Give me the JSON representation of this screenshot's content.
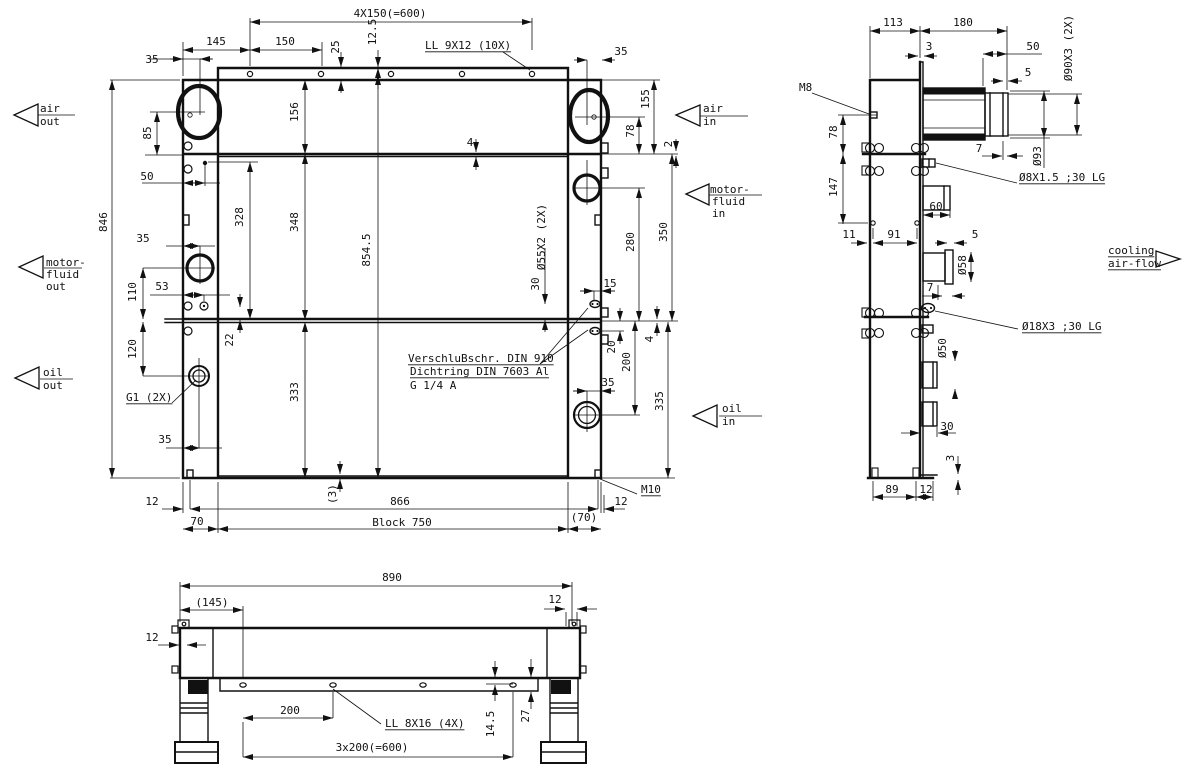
{
  "drawing": {
    "type": "technical engineering drawing",
    "subject": "combined oil / motor-fluid / air cooler with fan, three orthographic views",
    "front_view": {
      "texts": [
        {
          "t": "4X150(=600)",
          "x": 390,
          "y": 17
        },
        {
          "t": "12.5",
          "x": 376,
          "y": 32,
          "r": -90
        },
        {
          "t": "25",
          "x": 339,
          "y": 47,
          "r": -90
        },
        {
          "t": "145",
          "x": 216,
          "y": 45
        },
        {
          "t": "150",
          "x": 285,
          "y": 45
        },
        {
          "t": "35",
          "x": 152,
          "y": 63
        },
        {
          "t": "LL 9X12 (10X)",
          "x": 425,
          "y": 49,
          "a": "s",
          "ul": 1
        },
        {
          "t": "35",
          "x": 621,
          "y": 55
        },
        {
          "t": "846",
          "x": 107,
          "y": 222,
          "r": -90
        },
        {
          "t": "85",
          "x": 151,
          "y": 133,
          "r": -90
        },
        {
          "t": "156",
          "x": 298,
          "y": 112,
          "r": -90
        },
        {
          "t": "50",
          "x": 147,
          "y": 180
        },
        {
          "t": "328",
          "x": 243,
          "y": 217,
          "r": -90
        },
        {
          "t": "348",
          "x": 298,
          "y": 222,
          "r": -90
        },
        {
          "t": "854.5",
          "x": 370,
          "y": 250,
          "r": -90
        },
        {
          "t": "4",
          "x": 470,
          "y": 146
        },
        {
          "t": "35",
          "x": 143,
          "y": 242
        },
        {
          "t": "110",
          "x": 136,
          "y": 292,
          "r": -90
        },
        {
          "t": "53",
          "x": 162,
          "y": 290
        },
        {
          "t": "120",
          "x": 136,
          "y": 349,
          "r": -90
        },
        {
          "t": "22",
          "x": 233,
          "y": 340,
          "r": -90
        },
        {
          "t": "333",
          "x": 298,
          "y": 392,
          "r": -90
        },
        {
          "t": "G1 (2X)",
          "x": 126,
          "y": 401,
          "a": "s",
          "ul": 1
        },
        {
          "t": "35",
          "x": 165,
          "y": 443
        },
        {
          "t": "12",
          "x": 152,
          "y": 505
        },
        {
          "t": "70",
          "x": 197,
          "y": 525
        },
        {
          "t": "(3)",
          "x": 336,
          "y": 494,
          "r": -90
        },
        {
          "t": "866",
          "x": 400,
          "y": 505
        },
        {
          "t": "Block 750",
          "x": 402,
          "y": 526
        },
        {
          "t": "(70)",
          "x": 584,
          "y": 521
        },
        {
          "t": "12",
          "x": 621,
          "y": 505
        },
        {
          "t": "M10",
          "x": 641,
          "y": 493,
          "a": "s",
          "ul": 1
        },
        {
          "t": "Ø55X2 (2X)",
          "x": 545,
          "y": 237,
          "r": -90
        },
        {
          "t": "30",
          "x": 539,
          "y": 284,
          "r": -90
        },
        {
          "t": "15",
          "x": 610,
          "y": 287
        },
        {
          "t": "20",
          "x": 615,
          "y": 347,
          "r": -90
        },
        {
          "t": "200",
          "x": 630,
          "y": 362,
          "r": -90
        },
        {
          "t": "4",
          "x": 653,
          "y": 339,
          "r": -90
        },
        {
          "t": "335",
          "x": 663,
          "y": 401,
          "r": -90
        },
        {
          "t": "35",
          "x": 608,
          "y": 386
        },
        {
          "t": "350",
          "x": 667,
          "y": 232,
          "r": -90
        },
        {
          "t": "280",
          "x": 634,
          "y": 242,
          "r": -90
        },
        {
          "t": "78",
          "x": 634,
          "y": 131,
          "r": -90
        },
        {
          "t": "155",
          "x": 649,
          "y": 99,
          "r": -90
        },
        {
          "t": "2",
          "x": 672,
          "y": 144,
          "r": -90
        },
        {
          "t": "VerschluBschr. DIN 910",
          "x": 408,
          "y": 362,
          "a": "s",
          "ul": 1
        },
        {
          "t": "Dichtring DIN 7603 Al",
          "x": 410,
          "y": 375,
          "a": "s",
          "ul": 1
        },
        {
          "t": "G 1/4 A",
          "x": 410,
          "y": 389,
          "a": "s"
        },
        {
          "t": "air",
          "x": 40,
          "y": 112,
          "a": "s"
        },
        {
          "t": "out",
          "x": 40,
          "y": 125,
          "a": "s"
        },
        {
          "t": "motor-",
          "x": 46,
          "y": 266,
          "a": "s"
        },
        {
          "t": "fluid",
          "x": 46,
          "y": 278,
          "a": "s"
        },
        {
          "t": "out",
          "x": 46,
          "y": 290,
          "a": "s"
        },
        {
          "t": "oil",
          "x": 43,
          "y": 376,
          "a": "s"
        },
        {
          "t": "out",
          "x": 43,
          "y": 389,
          "a": "s"
        },
        {
          "t": "air",
          "x": 703,
          "y": 112,
          "a": "s"
        },
        {
          "t": "in",
          "x": 703,
          "y": 125,
          "a": "s"
        },
        {
          "t": "motor-",
          "x": 710,
          "y": 193,
          "a": "s"
        },
        {
          "t": "fluid",
          "x": 712,
          "y": 205,
          "a": "s"
        },
        {
          "t": "in",
          "x": 712,
          "y": 217,
          "a": "s"
        },
        {
          "t": "oil",
          "x": 722,
          "y": 412,
          "a": "s"
        },
        {
          "t": "in",
          "x": 722,
          "y": 425,
          "a": "s"
        }
      ]
    },
    "side_view": {
      "texts": [
        {
          "t": "113",
          "x": 893,
          "y": 26
        },
        {
          "t": "180",
          "x": 963,
          "y": 26
        },
        {
          "t": "3",
          "x": 929,
          "y": 50
        },
        {
          "t": "50",
          "x": 1033,
          "y": 50
        },
        {
          "t": "5",
          "x": 1028,
          "y": 76
        },
        {
          "t": "Ø90X3 (2X)",
          "x": 1072,
          "y": 48,
          "r": -90
        },
        {
          "t": "M8",
          "x": 799,
          "y": 91,
          "a": "s"
        },
        {
          "t": "78",
          "x": 837,
          "y": 132,
          "r": -90
        },
        {
          "t": "147",
          "x": 837,
          "y": 187,
          "r": -90
        },
        {
          "t": "7",
          "x": 979,
          "y": 152
        },
        {
          "t": "Ø93",
          "x": 1041,
          "y": 156,
          "r": -90
        },
        {
          "t": "Ø8X1.5 ;30 LG",
          "x": 1019,
          "y": 181,
          "a": "s",
          "ul": 1
        },
        {
          "t": "60",
          "x": 936,
          "y": 210
        },
        {
          "t": "11",
          "x": 849,
          "y": 238
        },
        {
          "t": "91",
          "x": 894,
          "y": 238
        },
        {
          "t": "5",
          "x": 975,
          "y": 238
        },
        {
          "t": "Ø58",
          "x": 966,
          "y": 265,
          "r": -90
        },
        {
          "t": "7",
          "x": 930,
          "y": 291
        },
        {
          "t": "Ø18X3 ;30 LG",
          "x": 1022,
          "y": 330,
          "a": "s",
          "ul": 1
        },
        {
          "t": "Ø50",
          "x": 946,
          "y": 348,
          "r": -90
        },
        {
          "t": "30",
          "x": 947,
          "y": 430
        },
        {
          "t": "3",
          "x": 954,
          "y": 458,
          "r": -90
        },
        {
          "t": "89",
          "x": 892,
          "y": 493
        },
        {
          "t": "12",
          "x": 926,
          "y": 493
        },
        {
          "t": "cooling",
          "x": 1108,
          "y": 254,
          "a": "s",
          "ul": 1
        },
        {
          "t": "air-flow",
          "x": 1108,
          "y": 267,
          "a": "s",
          "ul": 1
        }
      ]
    },
    "bottom_view": {
      "texts": [
        {
          "t": "890",
          "x": 392,
          "y": 581
        },
        {
          "t": "(145)",
          "x": 212,
          "y": 606
        },
        {
          "t": "12",
          "x": 555,
          "y": 603
        },
        {
          "t": "12",
          "x": 152,
          "y": 641
        },
        {
          "t": "200",
          "x": 290,
          "y": 714
        },
        {
          "t": "LL 8X16 (4X)",
          "x": 385,
          "y": 727,
          "a": "s",
          "ul": 1
        },
        {
          "t": "14.5",
          "x": 494,
          "y": 724,
          "r": -90
        },
        {
          "t": "27",
          "x": 529,
          "y": 716,
          "r": -90
        },
        {
          "t": "3x200(=600)",
          "x": 372,
          "y": 751
        }
      ]
    }
  }
}
